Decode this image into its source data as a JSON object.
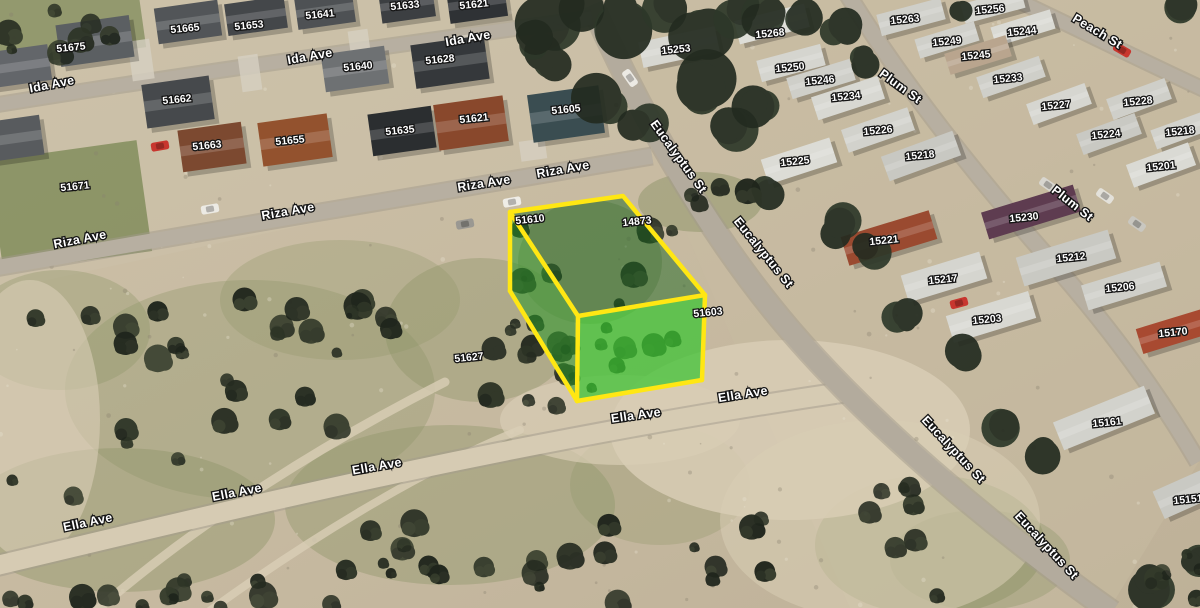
{
  "map": {
    "colors": {
      "parcel_outline": "#ffe713",
      "parcel_top_fill": "rgba(22,98,28,0.48)",
      "parcel_side_fill": "rgba(42,150,40,0.55)",
      "parcel_front_fill": "rgba(58,196,48,0.72)",
      "label_text": "#ffffff",
      "label_outline": "#141414"
    },
    "highlighted_parcel": {
      "top_face": [
        [
          510,
          212
        ],
        [
          623,
          196
        ],
        [
          705,
          295
        ],
        [
          578,
          316
        ]
      ],
      "left_face": [
        [
          510,
          212
        ],
        [
          578,
          316
        ],
        [
          577,
          401
        ],
        [
          510,
          291
        ]
      ],
      "front_face": [
        [
          578,
          316
        ],
        [
          705,
          295
        ],
        [
          702,
          380
        ],
        [
          577,
          401
        ]
      ],
      "vertical_edges": [
        [
          510,
          212,
          510,
          291
        ],
        [
          578,
          316,
          577,
          401
        ],
        [
          705,
          295,
          702,
          380
        ]
      ],
      "base_edges": [
        [
          510,
          291,
          577,
          401
        ],
        [
          577,
          401,
          702,
          380
        ]
      ]
    },
    "street_labels": [
      {
        "text": "Ida Ave",
        "x": 52,
        "y": 85,
        "rot": -11
      },
      {
        "text": "Ida Ave",
        "x": 310,
        "y": 57,
        "rot": -10
      },
      {
        "text": "Ida Ave",
        "x": 468,
        "y": 39,
        "rot": -10
      },
      {
        "text": "Riza Ave",
        "x": 80,
        "y": 240,
        "rot": -11
      },
      {
        "text": "Riza Ave",
        "x": 288,
        "y": 212,
        "rot": -10
      },
      {
        "text": "Riza Ave",
        "x": 484,
        "y": 184,
        "rot": -9
      },
      {
        "text": "Riza Ave",
        "x": 563,
        "y": 170,
        "rot": -10
      },
      {
        "text": "Ella Ave",
        "x": 88,
        "y": 523,
        "rot": -12
      },
      {
        "text": "Ella Ave",
        "x": 237,
        "y": 493,
        "rot": -11
      },
      {
        "text": "Ella Ave",
        "x": 377,
        "y": 467,
        "rot": -10
      },
      {
        "text": "Ella Ave",
        "x": 636,
        "y": 416,
        "rot": -8
      },
      {
        "text": "Ella Ave",
        "x": 743,
        "y": 395,
        "rot": -9
      },
      {
        "text": "Eucalyptus St",
        "x": 678,
        "y": 157,
        "rot": 54
      },
      {
        "text": "Eucalyptus St",
        "x": 763,
        "y": 253,
        "rot": 51
      },
      {
        "text": "Eucalyptus St",
        "x": 953,
        "y": 450,
        "rot": 47
      },
      {
        "text": "Eucalyptus St",
        "x": 1046,
        "y": 546,
        "rot": 47
      },
      {
        "text": "Plum St",
        "x": 900,
        "y": 87,
        "rot": 36
      },
      {
        "text": "Plum St",
        "x": 1072,
        "y": 204,
        "rot": 38
      },
      {
        "text": "Peach St",
        "x": 1097,
        "y": 32,
        "rot": 31
      }
    ],
    "parcel_labels": [
      {
        "text": "51675",
        "x": 71,
        "y": 48
      },
      {
        "text": "51665",
        "x": 185,
        "y": 29
      },
      {
        "text": "51653",
        "x": 249,
        "y": 26
      },
      {
        "text": "51641",
        "x": 320,
        "y": 15
      },
      {
        "text": "51633",
        "x": 405,
        "y": 6
      },
      {
        "text": "51621",
        "x": 474,
        "y": 5
      },
      {
        "text": "51662",
        "x": 177,
        "y": 100
      },
      {
        "text": "51640",
        "x": 358,
        "y": 67
      },
      {
        "text": "51628",
        "x": 440,
        "y": 60
      },
      {
        "text": "51663",
        "x": 207,
        "y": 146
      },
      {
        "text": "51655",
        "x": 290,
        "y": 141
      },
      {
        "text": "51635",
        "x": 400,
        "y": 131
      },
      {
        "text": "51621",
        "x": 474,
        "y": 119
      },
      {
        "text": "51605",
        "x": 566,
        "y": 110
      },
      {
        "text": "51671",
        "x": 75,
        "y": 187
      },
      {
        "text": "51627",
        "x": 469,
        "y": 358
      },
      {
        "text": "51610",
        "x": 530,
        "y": 220
      },
      {
        "text": "14873",
        "x": 637,
        "y": 222
      },
      {
        "text": "51603",
        "x": 708,
        "y": 313
      },
      {
        "text": "15263",
        "x": 905,
        "y": 20
      },
      {
        "text": "15256",
        "x": 990,
        "y": 10
      },
      {
        "text": "15249",
        "x": 947,
        "y": 42
      },
      {
        "text": "15244",
        "x": 1022,
        "y": 32
      },
      {
        "text": "15245",
        "x": 976,
        "y": 56
      },
      {
        "text": "15233",
        "x": 1008,
        "y": 79
      },
      {
        "text": "15253",
        "x": 676,
        "y": 50
      },
      {
        "text": "15268",
        "x": 770,
        "y": 34
      },
      {
        "text": "15250",
        "x": 790,
        "y": 68
      },
      {
        "text": "15246",
        "x": 820,
        "y": 81
      },
      {
        "text": "15234",
        "x": 846,
        "y": 97
      },
      {
        "text": "15226",
        "x": 878,
        "y": 131
      },
      {
        "text": "15225",
        "x": 795,
        "y": 162
      },
      {
        "text": "15218",
        "x": 920,
        "y": 156
      },
      {
        "text": "15227",
        "x": 1056,
        "y": 106
      },
      {
        "text": "15228",
        "x": 1138,
        "y": 102
      },
      {
        "text": "15224",
        "x": 1106,
        "y": 135
      },
      {
        "text": "15218",
        "x": 1180,
        "y": 132
      },
      {
        "text": "15201",
        "x": 1161,
        "y": 167
      },
      {
        "text": "15221",
        "x": 884,
        "y": 241
      },
      {
        "text": "15230",
        "x": 1024,
        "y": 218
      },
      {
        "text": "15212",
        "x": 1071,
        "y": 258
      },
      {
        "text": "15217",
        "x": 943,
        "y": 280
      },
      {
        "text": "15206",
        "x": 1120,
        "y": 288
      },
      {
        "text": "15203",
        "x": 987,
        "y": 320
      },
      {
        "text": "15170",
        "x": 1173,
        "y": 333
      },
      {
        "text": "15161",
        "x": 1107,
        "y": 423
      },
      {
        "text": "15151",
        "x": 1188,
        "y": 500
      }
    ]
  }
}
